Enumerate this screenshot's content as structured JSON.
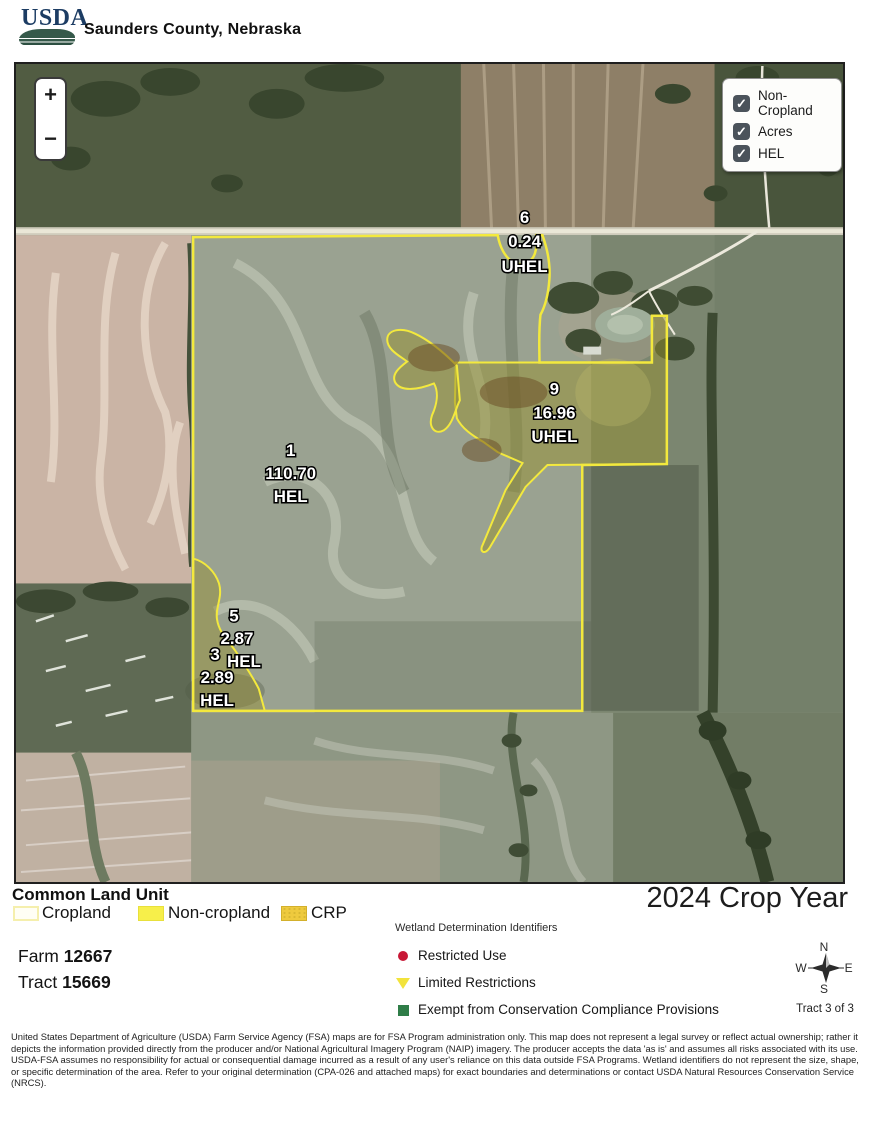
{
  "header": {
    "agency": "USDA",
    "title": "Saunders County, Nebraska"
  },
  "map": {
    "zoom_in": "+",
    "zoom_out": "−",
    "layers": [
      {
        "label": "Non-Cropland",
        "checked": true
      },
      {
        "label": "Acres",
        "checked": true
      },
      {
        "label": "HEL",
        "checked": true
      }
    ],
    "fields": [
      {
        "id": "6",
        "acres": "0.24",
        "hel": "UHEL"
      },
      {
        "id": "9",
        "acres": "16.96",
        "hel": "UHEL"
      },
      {
        "id": "1",
        "acres": "110.70",
        "hel": "HEL"
      },
      {
        "id": "5",
        "acres": "2.87",
        "hel": "HEL"
      },
      {
        "id": "3",
        "acres": "2.89",
        "hel": "HEL"
      }
    ]
  },
  "icons": {
    "check": "✓"
  },
  "footer": {
    "clu_title": "Common Land Unit",
    "clu_items": [
      {
        "label": "Cropland",
        "fill": "#fffef4"
      },
      {
        "label": "Non-cropland",
        "fill": "#f7ef4a"
      },
      {
        "label": "CRP",
        "fill": "#eeca3e"
      }
    ],
    "crop_year": "2024 Crop Year",
    "farm_label": "Farm",
    "farm_number": "12667",
    "tract_label": "Tract",
    "tract_number": "15669",
    "wetland_title": "Wetland Determination Identifiers",
    "wetland_items": [
      {
        "label": "Restricted Use",
        "icon": "red-circle",
        "color": "#c81836"
      },
      {
        "label": "Limited Restrictions",
        "icon": "yellow-triangle",
        "color": "#f2e33c"
      },
      {
        "label": "Exempt from Conservation Compliance Provisions",
        "icon": "green-square",
        "color": "#2f7d48"
      }
    ],
    "compass": {
      "n": "N",
      "e": "E",
      "s": "S",
      "w": "W"
    },
    "tract_page": "Tract 3 of 3",
    "disclaimer": "United States Department of Agriculture (USDA) Farm Service Agency (FSA) maps are for FSA Program administration only. This map does not represent a legal survey or reflect actual ownership; rather it depicts the information provided directly from the producer and/or National Agricultural Imagery Program (NAIP) imagery. The producer accepts the data 'as is' and assumes all risks associated with its use. USDA-FSA assumes no responsibility for actual or consequential damage incurred as a result of any user's reliance on this data outside FSA Programs. Wetland identifiers do not represent the size, shape, or specific determination of the area. Refer to your original determination (CPA-026 and attached maps) for exact boundaries and determinations or contact USDA Natural Resources Conservation Service (NRCS)."
  },
  "colors": {
    "boundary_yellow": "#f3e93d",
    "field9_fill": "rgba(150,143,48,0.5)",
    "checkbox": "#4b535b"
  }
}
